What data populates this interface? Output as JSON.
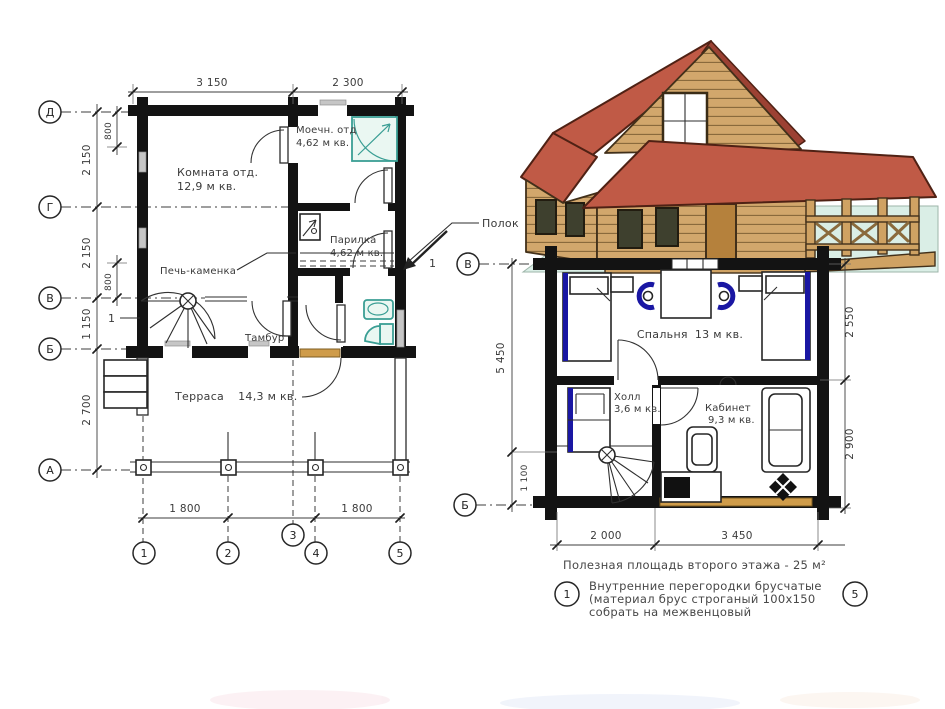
{
  "colors": {
    "wall": "#131313",
    "teal": "#3a9e94",
    "navy": "#1a17a3",
    "door_tan": "#cf9c4a",
    "roof_red": "#c05a46",
    "roof_dark": "#9c4133",
    "log_tan": "#d2a76c",
    "log_dark": "#8a6a3c",
    "ground_mint": "#daeee6"
  },
  "left_plan": {
    "axes_left": [
      "Д",
      "Г",
      "В",
      "Б",
      "А"
    ],
    "axes_bottom": [
      "1",
      "2",
      "3",
      "4",
      "5"
    ],
    "dims": {
      "top": [
        "3 150",
        "2 300"
      ],
      "left": [
        "2 150",
        "2 150",
        "1 150",
        "2 700"
      ],
      "inner": [
        "800",
        "800"
      ],
      "bottom": [
        "1 800",
        "1 800"
      ]
    },
    "rooms": {
      "rest_room": {
        "name": "Комната отд.",
        "area": "12,9 м кв."
      },
      "wash_room": {
        "name": "Моечн. отд",
        "area": "4,62 м кв."
      },
      "steam_room": {
        "name": "Парилка",
        "area": "4,62 м кв."
      },
      "vestibule": {
        "name": "Тамбур"
      },
      "terrace": {
        "name": "Терраса",
        "area": "14,3 м кв."
      }
    },
    "stove_label": "Печь-каменка",
    "shelf_label": "Полок",
    "section_mark": "1"
  },
  "right_plan": {
    "axes_left": [
      "В",
      "Б"
    ],
    "dims": {
      "left_total": "5 450",
      "left_lower": "1 100",
      "right": [
        "2 550",
        "2 900"
      ],
      "bottom": [
        "2 000",
        "3 450"
      ]
    },
    "rooms": {
      "bedroom": {
        "name": "Спальня",
        "area": "13 м кв."
      },
      "hall": {
        "name": "Холл",
        "area": "3,6 м кв."
      },
      "study": {
        "name": "Кабинет",
        "area": "9,3 м кв."
      }
    }
  },
  "notes": {
    "floor_area": "Полезная площадь второго этажа - 25 м²",
    "marker_start": "1",
    "marker_end": "5",
    "lines": [
      "Внутренние перегородки брусчатые",
      "(материал брус строганый 100х150",
      "собрать на межвенцовый"
    ]
  }
}
